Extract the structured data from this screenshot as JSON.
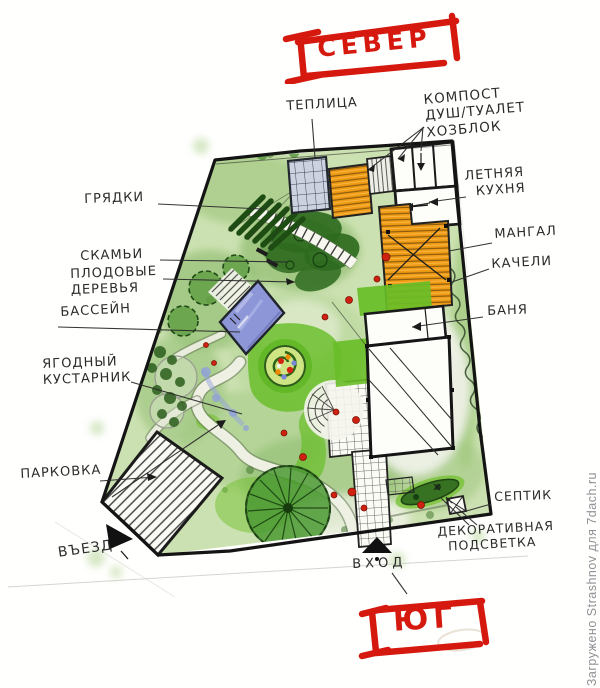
{
  "compass": {
    "north": "СЕВЕР",
    "south": "ЮГ"
  },
  "labels": {
    "teplitsa": "ТЕПЛИЦА",
    "kompost": "КОМПОСТ\nДУШ/ТУАЛЕТ\nХОЗБЛОК",
    "letnyaya_kuhnya": "ЛЕТНЯЯ\n  КУХНЯ",
    "gryadki": "ГРЯДКИ",
    "mangal": "МАНГАЛ",
    "kacheli": "КАЧЕЛИ",
    "skami": "СКАМЬИ",
    "plodovye_derevya": "ПЛОДОВЫЕ\nДЕРЕВЬЯ",
    "bassein": "БАССЕЙН",
    "banya": "БАНЯ",
    "yagodny_kustarnik": "ЯГОДНЫЙ\nКУСТАРНИК",
    "parkovka": "ПАРКОВКА",
    "vezd": "ВЪЕЗД",
    "vhod": "ВХОД",
    "septik": "СЕПТИК",
    "podsvetka": "ДЕКОРАТИВНАЯ\n  ПОДСВЕТКА"
  },
  "watermark": "Загружено Strashnov для 7dach.ru",
  "palette": {
    "marker_red": "#d6190f",
    "ink_black": "#1d1d1d",
    "base_wash_green": "#c9dfad",
    "lawn_green": "#68be27",
    "dark_foliage_green": "#2e6a1f",
    "deck_orange": "#ef9b13",
    "pool_blue": "#8d96d6",
    "pencil_gray": "#b0b0a8"
  }
}
